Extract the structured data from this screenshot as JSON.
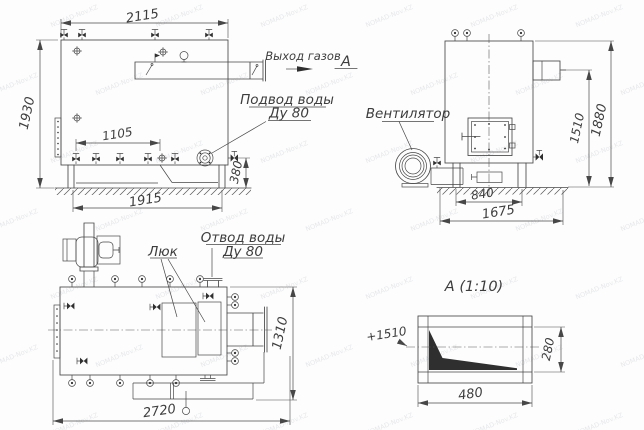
{
  "watermark": "NOMAD-Nov.KZ",
  "drawing": {
    "side_view": {
      "dim_width_top": "2115",
      "dim_height": "1930",
      "dim_drain_span": "1105",
      "dim_base_width": "1915",
      "dim_outlet_height": "380",
      "label_gas_outlet": "Выход газов",
      "label_water_inlet_1": "Подвод воды",
      "label_water_inlet_2": "Ду 80",
      "view_arrow_label": "А"
    },
    "front_view": {
      "dim_outlet_elev": "1510",
      "dim_total_height": "1880",
      "dim_base_span": "840",
      "dim_total_depth": "1675",
      "label_fan": "Вентилятор"
    },
    "plan_view": {
      "dim_length": "2720",
      "dim_width": "1310",
      "label_hatch": "Люк",
      "label_water_outlet_1": "Отвод воды",
      "label_water_outlet_2": "Ду 80"
    },
    "detail_view": {
      "title": "А (1:10)",
      "dim_width": "480",
      "dim_height": "280",
      "dim_elevation": "+1510"
    }
  }
}
